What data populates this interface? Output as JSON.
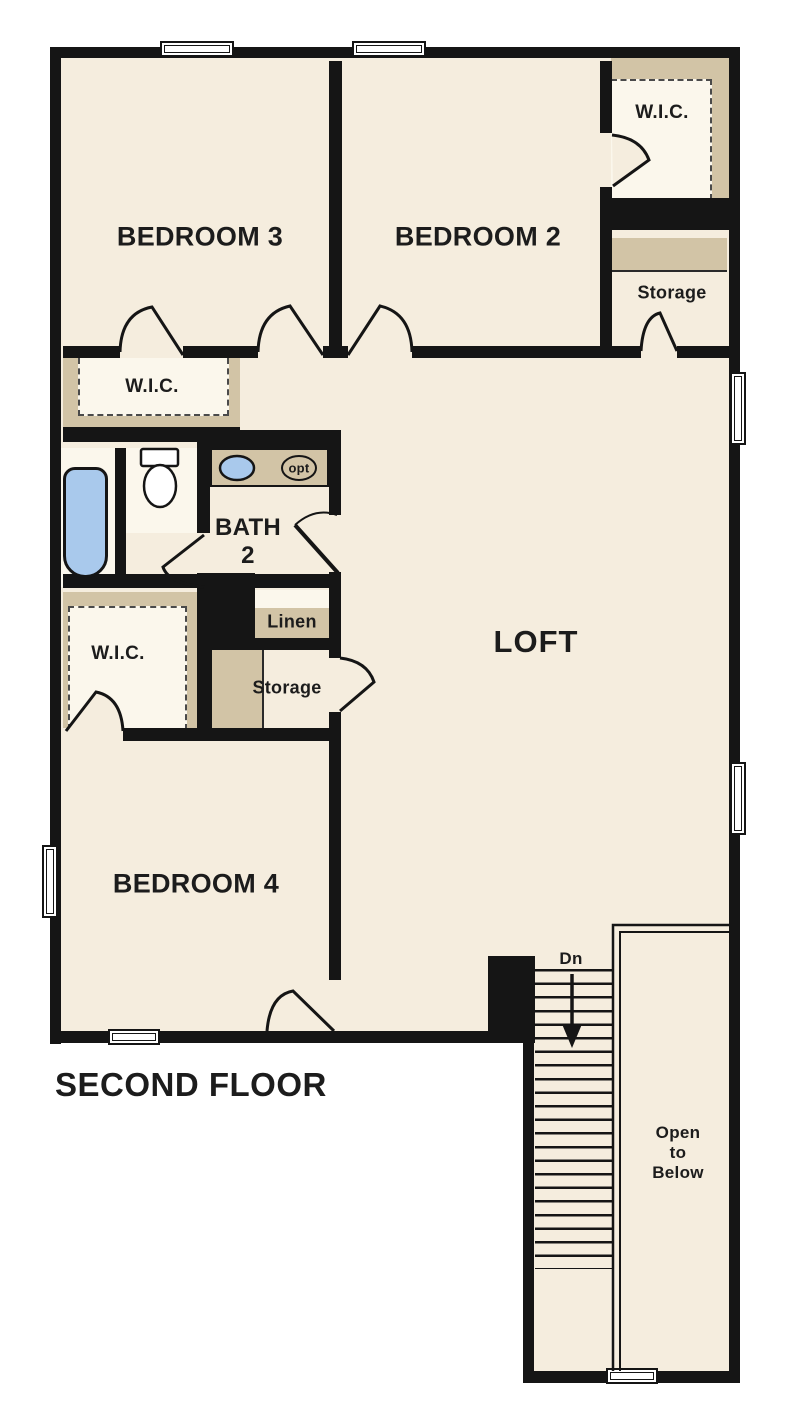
{
  "plan": {
    "title": "SECOND FLOOR",
    "rooms": {
      "bedroom3": "BEDROOM 3",
      "bedroom2": "BEDROOM 2",
      "bedroom4": "BEDROOM 4",
      "loft": "LOFT",
      "bath_line1": "BATH",
      "bath_line2": "2",
      "wic_top_right": "W.I.C.",
      "wic_mid_left": "W.I.C.",
      "wic_lower_left": "W.I.C.",
      "storage_top_right": "Storage",
      "storage_hall": "Storage",
      "linen": "Linen"
    },
    "stairs": {
      "down_label": "Dn",
      "open_to_below_line1": "Open",
      "open_to_below_line2": "to",
      "open_to_below_line3": "Below"
    },
    "fixtures": {
      "optional_sink_label": "opt"
    },
    "colors": {
      "wall": "#151515",
      "floor": "#f5edde",
      "closet_shelf_tan": "#d2c4a6",
      "fixture_blue": "#a9c9ec",
      "background": "#ffffff"
    }
  }
}
